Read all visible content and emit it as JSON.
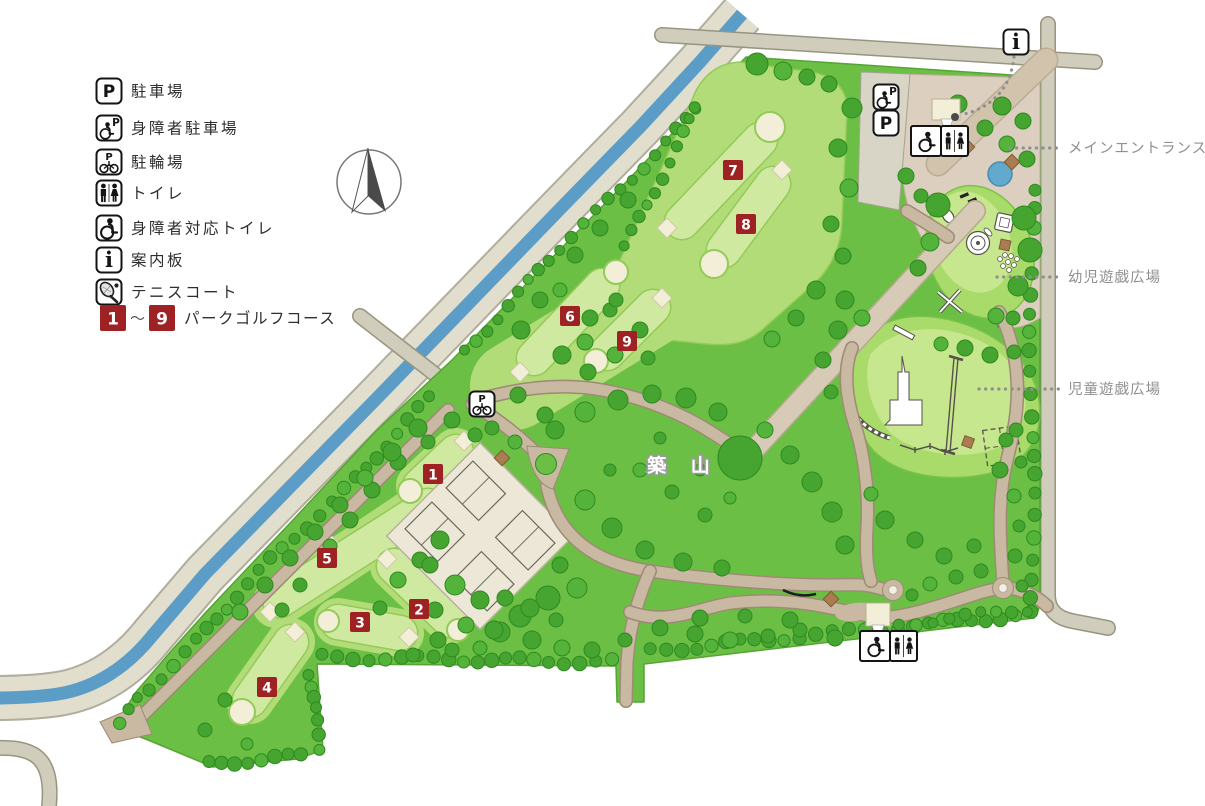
{
  "colors": {
    "park_green": "#6cbf45",
    "park_edge": "#55a434",
    "tree_green": "#46a431",
    "tree_edge": "#2e8a1e",
    "tree_light": "#54b33a",
    "fairway_outer": "#b2dc78",
    "fairway_inner": "#cfeaa0",
    "fairway_edge": "#93ca58",
    "cream": "#f2eed8",
    "cream_edge": "#cfc8a4",
    "river_blue": "#5b9dc6",
    "bank": "#e1decd",
    "bank_edge": "#b0ad9b",
    "road": "#d0cdbc",
    "road_edge": "#98957f",
    "parking_strip": "#d8d5c7",
    "path_tan": "#c9b8a2",
    "path_edge": "#9d8b74",
    "walkway": "#d7cab6",
    "walkway_edge": "#b6a98f",
    "plaza": "#dccfbf",
    "plaza_edge": "#bbac96",
    "drive": "#d2c3ac",
    "pond_blue": "#62a9ce",
    "pond_edge": "#4a8cb3",
    "marker_red": "#9e2123",
    "label_grey": "#8f8f8f",
    "legend_ink": "#2e2e2e",
    "ink": "#141414",
    "brown": "#aa7c50",
    "brown_edge": "#7d5a35",
    "court": "#ece7d7",
    "court_line": "#6b685c"
  },
  "glyphs": {
    "parking_letter": "P",
    "info_letter": "i"
  },
  "legend": {
    "items": [
      {
        "icon": "parking",
        "label": "駐車場"
      },
      {
        "icon": "wheelchair-parking",
        "label": "身障者駐車場"
      },
      {
        "icon": "bicycle-parking",
        "label": "駐輪場"
      },
      {
        "icon": "toilet",
        "label": "トイレ"
      },
      {
        "icon": "accessible-toilet",
        "label": "身障者対応トイレ"
      },
      {
        "icon": "info-board",
        "label": "案内板"
      },
      {
        "icon": "tennis-court",
        "label": "テニスコート"
      }
    ],
    "golf": {
      "from": "1",
      "tilde": "～",
      "to": "9",
      "label": "パークゴルフコース"
    }
  },
  "map": {
    "hill_label": {
      "text": "築 山",
      "x": 683,
      "y": 472
    },
    "leader_labels": [
      {
        "text": "メインエントランス広場",
        "tx": 1068,
        "ty": 153,
        "x1": 1010,
        "y1": 148,
        "x2": 1062,
        "y2": 148
      },
      {
        "text": "幼児遊戯広場",
        "tx": 1068,
        "ty": 282,
        "x1": 997,
        "y1": 277,
        "x2": 1062,
        "y2": 277
      },
      {
        "text": "児童遊戯広場",
        "tx": 1068,
        "ty": 394,
        "x1": 979,
        "y1": 389,
        "x2": 1062,
        "y2": 389
      }
    ],
    "golf_markers": [
      {
        "n": "1",
        "x": 433,
        "y": 474
      },
      {
        "n": "2",
        "x": 419,
        "y": 609
      },
      {
        "n": "3",
        "x": 360,
        "y": 622
      },
      {
        "n": "4",
        "x": 267,
        "y": 687
      },
      {
        "n": "5",
        "x": 327,
        "y": 558
      },
      {
        "n": "6",
        "x": 570,
        "y": 316
      },
      {
        "n": "7",
        "x": 733,
        "y": 170
      },
      {
        "n": "8",
        "x": 746,
        "y": 224
      },
      {
        "n": "9",
        "x": 627,
        "y": 341
      }
    ],
    "icons": [
      {
        "type": "wheelchair-parking",
        "x": 886,
        "y": 97
      },
      {
        "type": "parking",
        "x": 886,
        "y": 123
      },
      {
        "type": "toilet-accessible-combo",
        "x": 940,
        "y": 141
      },
      {
        "type": "bicycle-parking",
        "x": 482,
        "y": 404
      },
      {
        "type": "toilet-accessible-combo",
        "x": 889,
        "y": 646
      },
      {
        "type": "info-board",
        "x": 1016,
        "y": 42
      }
    ],
    "info_leader": {
      "d": "M1014,57 C1011,86 994,108 960,115",
      "dot_x": 955,
      "dot_y": 117
    }
  }
}
